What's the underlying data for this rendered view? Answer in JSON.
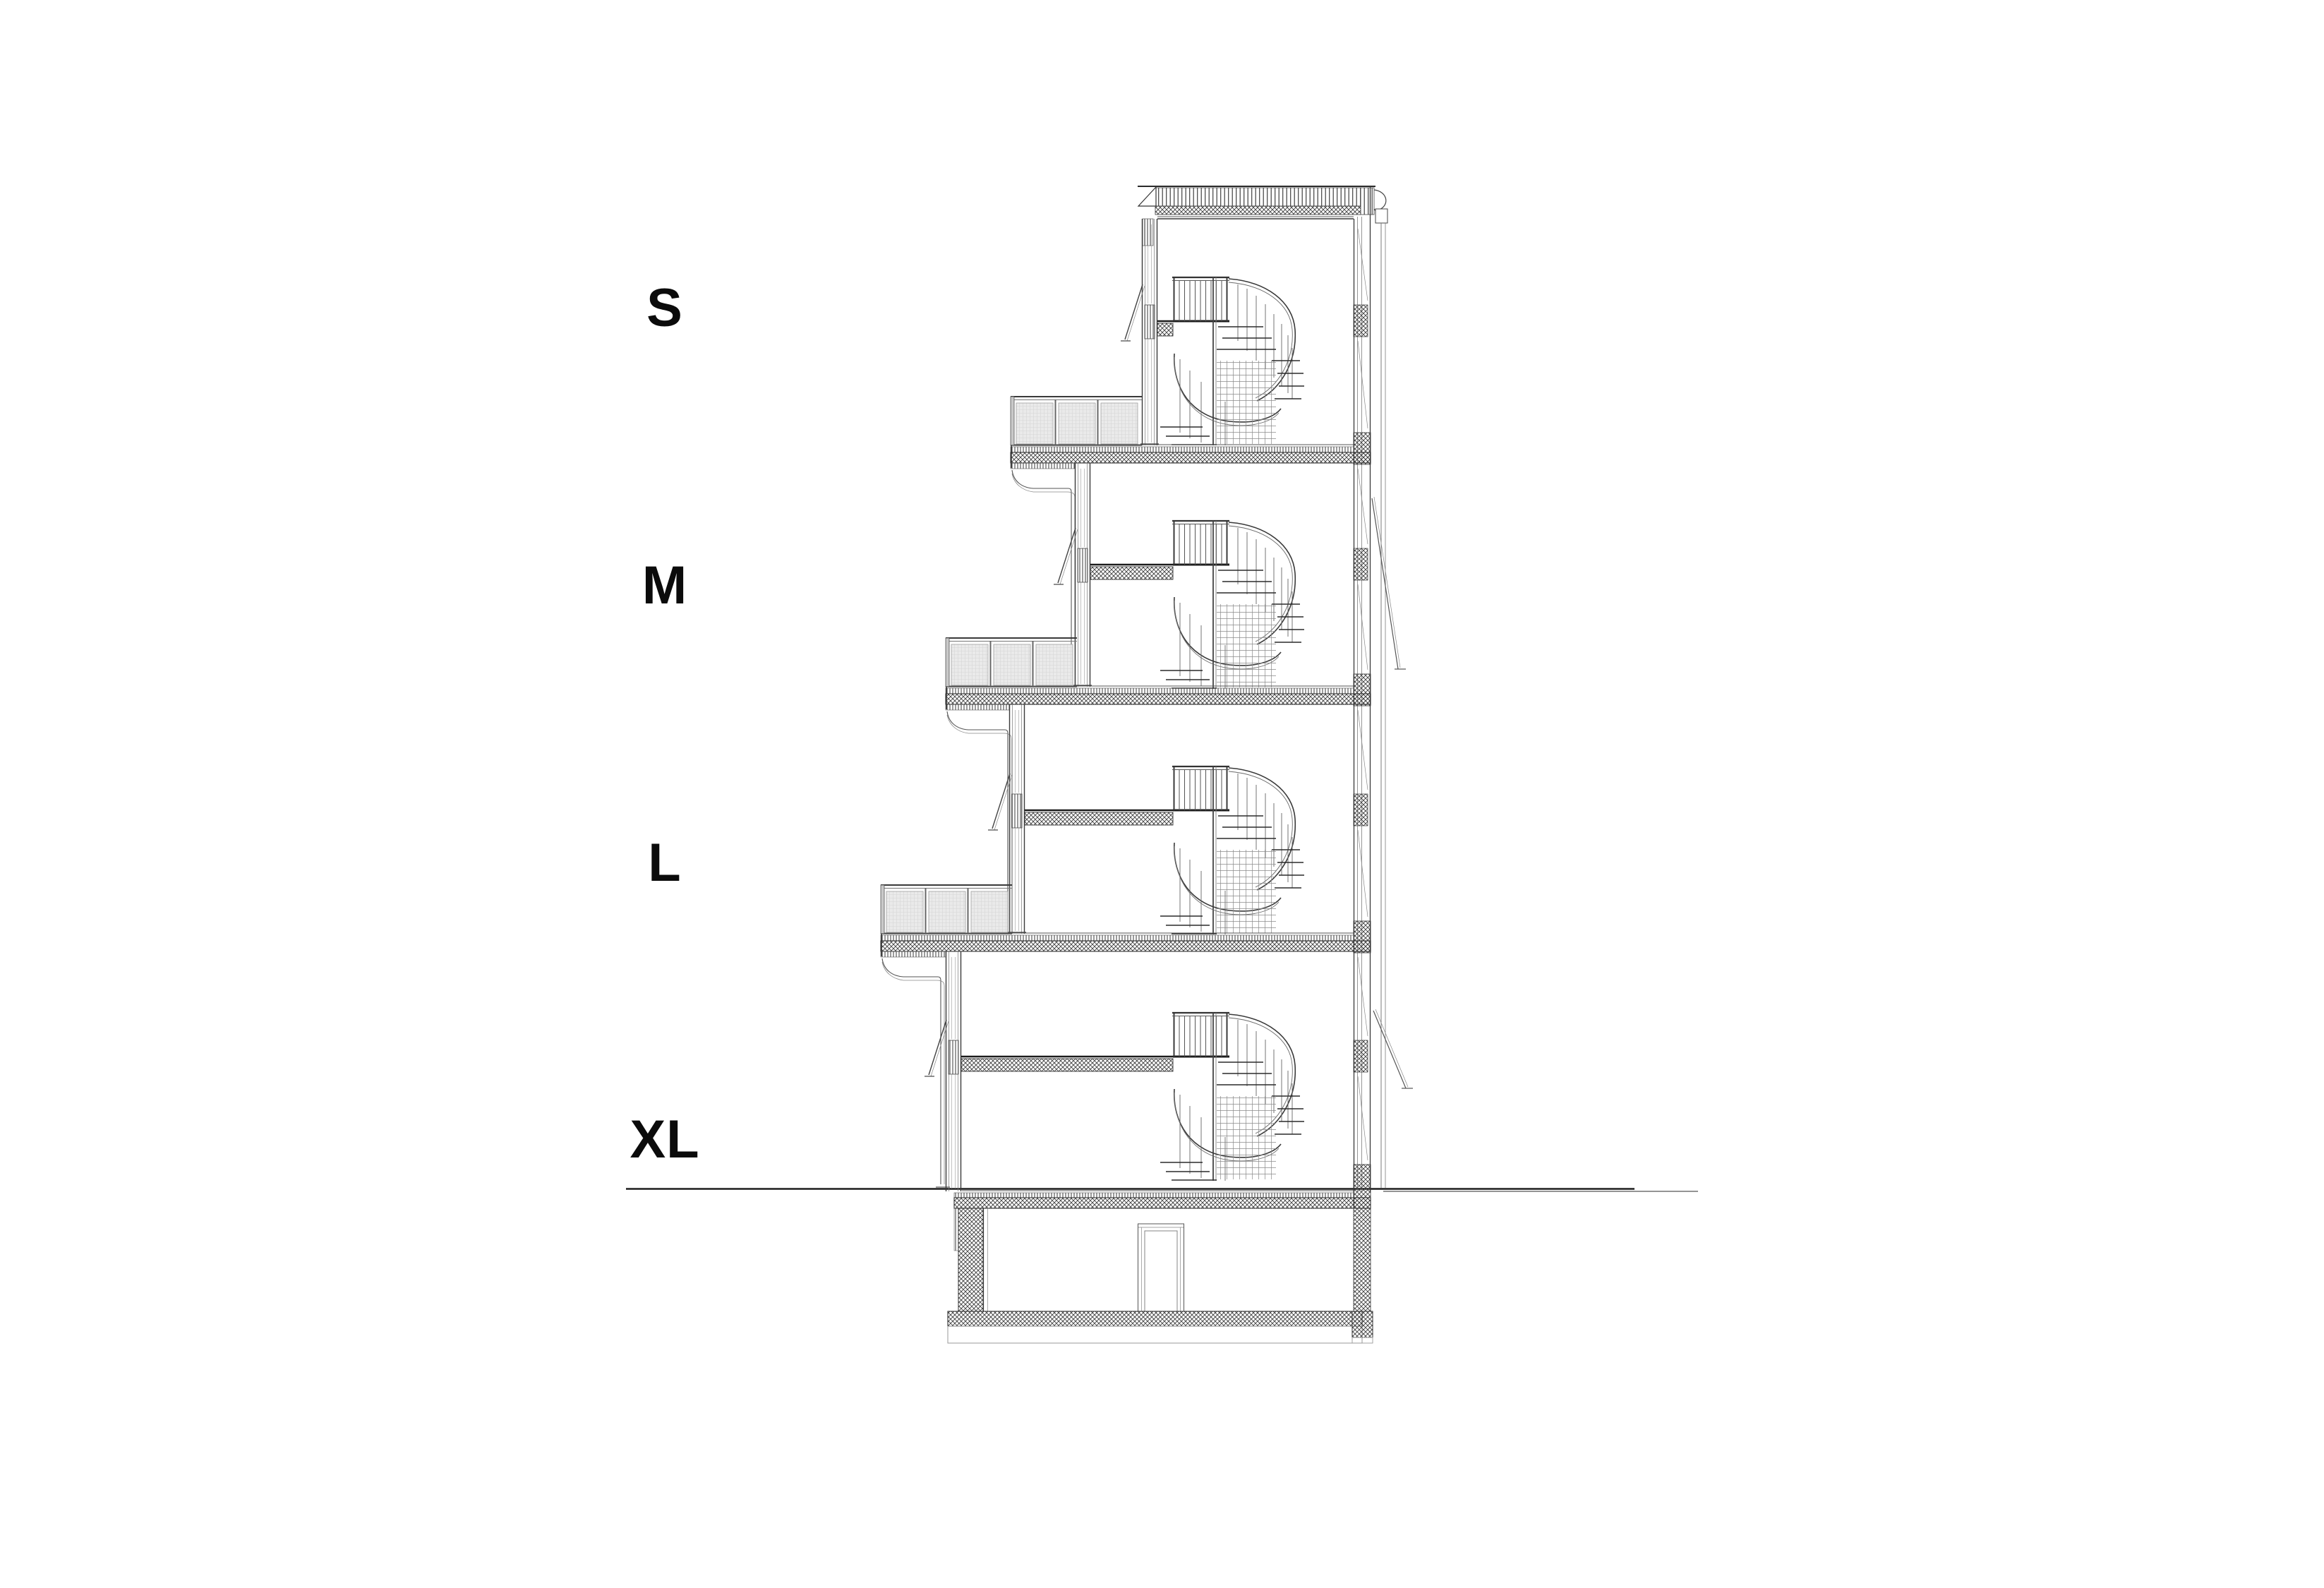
{
  "figure": {
    "kind": "architectural cross-section drawing",
    "floor_labels": [
      {
        "id": "s",
        "label": "S"
      },
      {
        "id": "m",
        "label": "M"
      },
      {
        "id": "l",
        "label": "L"
      },
      {
        "id": "xl",
        "label": "XL"
      }
    ],
    "colors": {
      "background": "#ffffff",
      "ink": "#3a3a3a",
      "dark_ink": "#161616",
      "hatch": "#3c3c3c",
      "panel_fill": "#eaeaea"
    }
  }
}
